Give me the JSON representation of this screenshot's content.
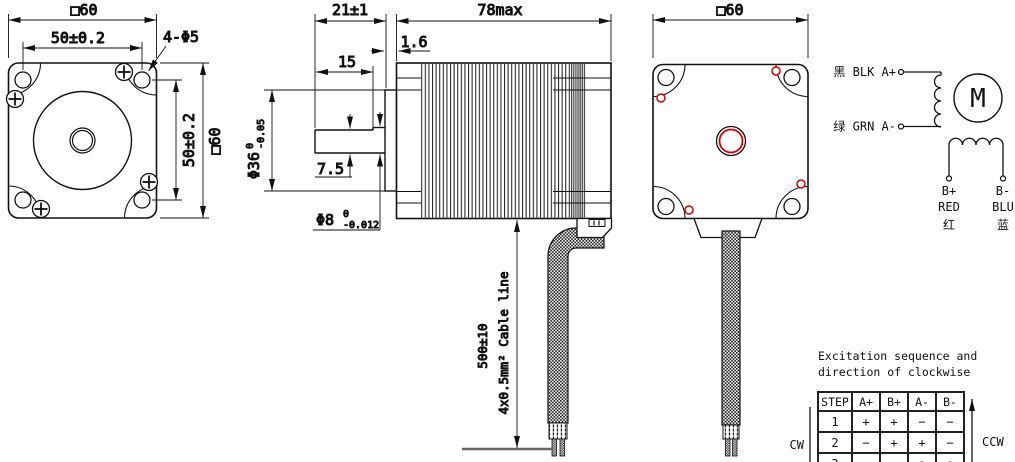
{
  "colors": {
    "line": "#111111",
    "accent_red": "#d40000"
  },
  "front_view": {
    "dim_width_top": "□60",
    "dim_hole_spacing_h": "50±0.2",
    "dim_corner_holes": "4-Φ5",
    "dim_hole_spacing_v": "50±0.2",
    "dim_height_right": "□60"
  },
  "side_view": {
    "dim_shaft_length": "21±1",
    "dim_body_length": "78max",
    "dim_boss_thickness": "1.6",
    "dim_shaft_flat_length": "15",
    "dim_pilot_diameter": "Φ36",
    "pilot_tol_upper": "0",
    "pilot_tol_lower": "-0.05",
    "dim_shaft_flat_depth": "7.5",
    "dim_shaft_diameter": "Φ8",
    "shaft_tol_upper": "0",
    "shaft_tol_lower": "-0.012",
    "dim_cable_length": "500±10",
    "cable_spec": "4x0.5mm² Cable line"
  },
  "rear_view": {
    "dim_width_top": "□60"
  },
  "wiring": {
    "phase_a_plus_label": "黑 BLK A+",
    "phase_a_minus_label": "绿 GRN A-",
    "motor_symbol": "M",
    "b_plus_terminal": "B+",
    "b_plus_color": "RED",
    "b_plus_cn": "红",
    "b_minus_terminal": "B-",
    "b_minus_color": "BLU",
    "b_minus_cn": "蓝"
  },
  "excitation_table": {
    "title_line1": "Excitation sequence and",
    "title_line2": "direction of clockwise",
    "headers": [
      "STEP",
      "A+",
      "B+",
      "A-",
      "B-"
    ],
    "rows": [
      [
        "1",
        "+",
        "+",
        "−",
        "−"
      ],
      [
        "2",
        "−",
        "+",
        "+",
        "−"
      ],
      [
        "3",
        "−",
        "−",
        "+",
        "+"
      ]
    ],
    "cw_label": "CW",
    "ccw_label": "CCW"
  }
}
